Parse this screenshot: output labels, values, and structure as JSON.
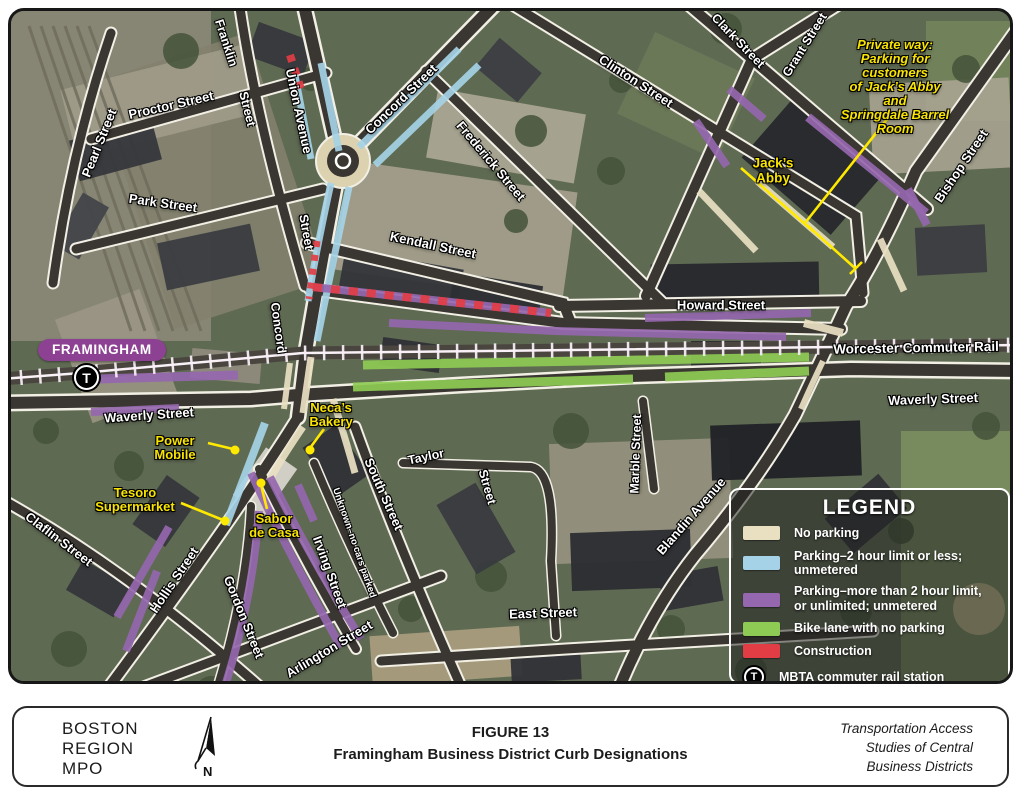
{
  "map": {
    "badge": "FRAMINGHAM",
    "station_letter": "T",
    "streets": {
      "pearl": "Pearl Street",
      "proctor": "Proctor Street",
      "park": "Park Street",
      "franklin_a": "Franklin",
      "franklin_b": "Street",
      "union": "Union Avenue",
      "concord_ne": "Concord Street",
      "frederick": "Frederick Street",
      "clinton": "Clinton Street",
      "kendall": "Kendall Street",
      "clark": "Clark Street",
      "grant": "Grant Street",
      "bishop": "Bishop Street",
      "howard": "Howard Street",
      "worcester": "Worcester Commuter Rail",
      "waverly_e": "Waverly Street",
      "waverly_w": "Waverly Street",
      "concord_s_b": "Street",
      "concord_s_a": "Concord",
      "marble": "Marble Street",
      "blandin": "Blandin Avenue",
      "east": "East Street",
      "south": "South Street",
      "taylor_a": "Taylor",
      "taylor_b": "Street",
      "claflin": "Claflin Street",
      "hollis": "Hollis Street",
      "gordon": "Gordon Street",
      "irving": "Irving Street",
      "arlington": "Arlington Street",
      "unknown": "Unknown–no cars parked"
    },
    "pois": {
      "private_way": "Private way:\nParking for customers\nof Jack’s Abby and\nSpringdale Barrel Room",
      "jacks_abby": "Jack’s\nAbby",
      "necas": "Neca’s\nBakery",
      "power": "Power\nMobile",
      "tesoro": "Tesoro\nSupermarket",
      "sabor": "Sabor\nde Casa"
    }
  },
  "legend": {
    "title": "LEGEND",
    "items": [
      {
        "label": "No parking",
        "color": "#e9e0c2"
      },
      {
        "label": "Parking–2 hour limit or less; unmetered",
        "color": "#a5d2e6"
      },
      {
        "label": "Parking–more than 2 hour limit, or unlimited; unmetered",
        "color": "#9567ae"
      },
      {
        "label": "Bike lane with no parking",
        "color": "#8ecb54"
      },
      {
        "label": "Construction",
        "color": "#e23d44"
      },
      {
        "label": "MBTA commuter rail station",
        "color": ""
      }
    ]
  },
  "footer": {
    "org": [
      "BOSTON",
      "REGION",
      "MPO"
    ],
    "figure_label": "FIGURE 13",
    "figure_title": "Framingham Business District Curb Designations",
    "program": [
      "Transportation Access",
      "Studies of Central",
      "Business Districts"
    ]
  },
  "colors": {
    "no_parking": "#e9e0c2",
    "parking_2hr": "#a5d2e6",
    "parking_long": "#9567ae",
    "bike_lane": "#8ecb54",
    "construction": "#e23d44",
    "badge_purple": "#8c4193",
    "label_yellow": "#f8e400"
  }
}
